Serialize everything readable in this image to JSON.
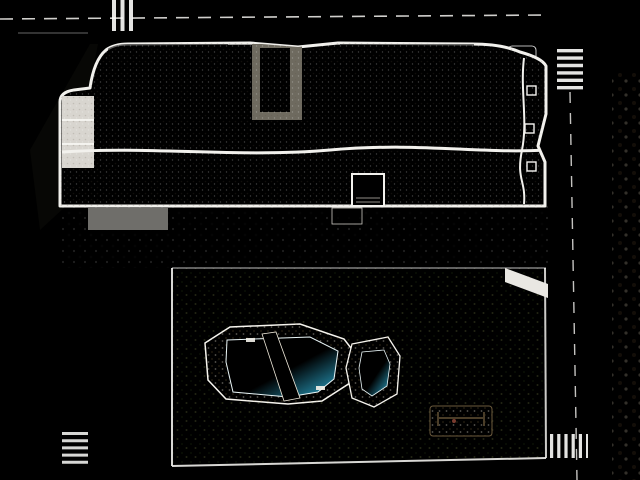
{
  "scene_description": "Aerial 3D architectural render of a white apartment complex with gravel roof terraces and parasols, a landscaped garden with a freeform swimming pool and kids pool, parking strip, surrounding streets and a sandy vacant lot",
  "colors": {
    "road": "#c0beba",
    "road_dark": "#b3b1ad",
    "sidewalk_top": "#d6c5b1",
    "sidewalk_left": "#dcc6b4",
    "sidewalk_pink": "#cf9a89",
    "dirt": "#c2a17c",
    "dirt_dark": "#9b8160",
    "grass": "#6f7d3f",
    "grass_dark": "#5b6a34",
    "terrace_grass": "#576139",
    "concrete": "#b7b5af",
    "parking": "#a9a7a1",
    "deck_stone": "#c9b38a",
    "planter_sand": "#c3a268",
    "pool_water": "#41bddd",
    "pool_water_light": "#90ddef",
    "roof_gravel": "#c6baa6",
    "roof_gravel_light": "#d3c8b3",
    "roof_dark": "#8d8779",
    "roof_black": "#32312d",
    "parapet_white": "#f2f1ed",
    "parasol_white": "#f7f6f2",
    "tree_light": "#b6ba6e",
    "tree_mid": "#7d8c4a",
    "tree_dark": "#46582c",
    "palm_dark": "#3f5a2c",
    "hedge": "#3d5429",
    "car_dark": "#3a3d40",
    "car_white": "#ebeae6",
    "car_silver": "#b9bdbf",
    "car_blue": "#5c6e80",
    "shadow": "#23251c"
  },
  "scene": {
    "parasols": [
      {
        "x": 102,
        "y": 54,
        "s": 24,
        "r": 15
      },
      {
        "x": 88,
        "y": 118,
        "s": 28,
        "r": -12
      },
      {
        "x": 228,
        "y": 118,
        "s": 28,
        "r": 10
      },
      {
        "x": 262,
        "y": 66,
        "s": 24,
        "r": -8
      },
      {
        "x": 330,
        "y": 64,
        "s": 26,
        "r": 12
      },
      {
        "x": 280,
        "y": 124,
        "s": 24,
        "r": 42
      },
      {
        "x": 316,
        "y": 124,
        "s": 24,
        "r": -18
      },
      {
        "x": 448,
        "y": 60,
        "s": 24,
        "r": -10
      },
      {
        "x": 476,
        "y": 60,
        "s": 26,
        "r": 14
      },
      {
        "x": 346,
        "y": 128,
        "s": 20,
        "r": -28
      },
      {
        "x": 496,
        "y": 130,
        "s": 24,
        "r": 18
      },
      {
        "x": 398,
        "y": 50,
        "s": 22,
        "r": 8
      }
    ],
    "roof_acs": [
      {
        "x": 168,
        "y": 118
      },
      {
        "x": 190,
        "y": 62
      },
      {
        "x": 208,
        "y": 94
      },
      {
        "x": 214,
        "y": 128
      },
      {
        "x": 238,
        "y": 86
      },
      {
        "x": 312,
        "y": 66
      },
      {
        "x": 318,
        "y": 126
      },
      {
        "x": 342,
        "y": 126
      },
      {
        "x": 366,
        "y": 98
      },
      {
        "x": 402,
        "y": 126
      },
      {
        "x": 412,
        "y": 64
      },
      {
        "x": 434,
        "y": 90
      },
      {
        "x": 448,
        "y": 128
      },
      {
        "x": 470,
        "y": 62
      },
      {
        "x": 492,
        "y": 126
      },
      {
        "x": 508,
        "y": 90
      },
      {
        "x": 524,
        "y": 62
      },
      {
        "x": 530,
        "y": 120
      }
    ],
    "roof_hatches": [
      {
        "x": 160,
        "y": 56
      },
      {
        "x": 254,
        "y": 124
      },
      {
        "x": 302,
        "y": 56
      },
      {
        "x": 354,
        "y": 126
      },
      {
        "x": 420,
        "y": 56
      },
      {
        "x": 500,
        "y": 56
      },
      {
        "x": 286,
        "y": 92
      },
      {
        "x": 452,
        "y": 92
      }
    ],
    "roof_loungers": [
      {
        "x": 296,
        "y": 108,
        "n": 2
      },
      {
        "x": 330,
        "y": 114,
        "n": 3
      },
      {
        "x": 408,
        "y": 116,
        "n": 2
      },
      {
        "x": 462,
        "y": 100,
        "n": 2
      }
    ],
    "terrace_boxes": [
      {
        "x": 64,
        "w": 46
      },
      {
        "x": 112,
        "w": 46
      },
      {
        "x": 160,
        "w": 46
      },
      {
        "x": 208,
        "w": 46
      },
      {
        "x": 256,
        "w": 46
      },
      {
        "x": 304,
        "w": 46
      },
      {
        "x": 384,
        "w": 46
      },
      {
        "x": 432,
        "w": 46
      },
      {
        "x": 480,
        "w": 40
      },
      {
        "x": 522,
        "w": 21
      }
    ],
    "planters": [
      {
        "x": 128,
        "y": 238,
        "w": 62,
        "h": 24
      },
      {
        "x": 243,
        "y": 236,
        "w": 66,
        "h": 24
      },
      {
        "x": 406,
        "y": 236,
        "w": 66,
        "h": 22
      }
    ],
    "benches": [
      {
        "x": 74,
        "y": 246,
        "w": 20,
        "h": 5
      },
      {
        "x": 200,
        "y": 230,
        "w": 16,
        "h": 4
      },
      {
        "x": 322,
        "y": 230,
        "w": 16,
        "h": 4
      },
      {
        "x": 488,
        "y": 230,
        "w": 14,
        "h": 4
      }
    ],
    "slat_groups": [
      {
        "x": 352,
        "y": 268,
        "n": 7,
        "w": 26,
        "h": 4,
        "gap": 2.5,
        "r": -2,
        "c": "#c49f63"
      },
      {
        "x": 468,
        "y": 348,
        "n": 6,
        "w": 26,
        "h": 5,
        "gap": 2.5,
        "r": 0,
        "c": "#cbb184"
      }
    ],
    "trees": [
      {
        "x": 196,
        "y": 288,
        "r": 22,
        "t": "light"
      },
      {
        "x": 238,
        "y": 296,
        "r": 16,
        "t": "mid"
      },
      {
        "x": 262,
        "y": 300,
        "r": 12,
        "t": "dark"
      },
      {
        "x": 300,
        "y": 288,
        "r": 14,
        "t": "dark"
      },
      {
        "x": 336,
        "y": 292,
        "r": 12,
        "t": "mid"
      },
      {
        "x": 428,
        "y": 292,
        "r": 12,
        "t": "dark"
      },
      {
        "x": 452,
        "y": 288,
        "r": 10,
        "t": "mid"
      },
      {
        "x": 516,
        "y": 296,
        "r": 20,
        "t": "light"
      },
      {
        "x": 542,
        "y": 306,
        "r": 14,
        "t": "mid"
      },
      {
        "x": 178,
        "y": 322,
        "r": 12,
        "t": "mid"
      },
      {
        "x": 186,
        "y": 452,
        "r": 16,
        "t": "light"
      },
      {
        "x": 214,
        "y": 466,
        "r": 12,
        "t": "mid"
      },
      {
        "x": 540,
        "y": 336,
        "r": 16,
        "t": "light"
      },
      {
        "x": 534,
        "y": 390,
        "r": 14,
        "t": "mid"
      },
      {
        "x": 544,
        "y": 448,
        "r": 18,
        "t": "light"
      },
      {
        "x": 306,
        "y": 428,
        "r": 14,
        "t": "mid"
      },
      {
        "x": 330,
        "y": 458,
        "r": 16,
        "t": "light"
      },
      {
        "x": 444,
        "y": 462,
        "r": 14,
        "t": "mid"
      },
      {
        "x": 252,
        "y": 470,
        "r": 12,
        "t": "mid"
      },
      {
        "x": 386,
        "y": 470,
        "r": 10,
        "t": "dark"
      },
      {
        "x": 206,
        "y": 330,
        "r": 8,
        "t": "dark"
      },
      {
        "x": 560,
        "y": 468,
        "r": 12,
        "t": "mid"
      }
    ],
    "palms": [
      {
        "x": 304,
        "y": 37,
        "r": 9
      },
      {
        "x": 430,
        "y": 36,
        "r": 9
      },
      {
        "x": 547,
        "y": 37,
        "r": 8
      },
      {
        "x": 614,
        "y": 24,
        "r": 10
      },
      {
        "x": 633,
        "y": 42,
        "r": 7
      }
    ],
    "bushes_left": [
      {
        "x": 10,
        "y": 150,
        "r": 6
      },
      {
        "x": 4,
        "y": 212,
        "r": 5
      },
      {
        "x": 16,
        "y": 300,
        "r": 7
      },
      {
        "x": 8,
        "y": 372,
        "r": 6
      },
      {
        "x": 20,
        "y": 442,
        "r": 7
      },
      {
        "x": 34,
        "y": 466,
        "r": 6
      }
    ],
    "bushes_dirt": [
      {
        "x": 600,
        "y": 160,
        "r": 4
      },
      {
        "x": 606,
        "y": 215,
        "r": 5
      },
      {
        "x": 598,
        "y": 262,
        "r": 4
      },
      {
        "x": 604,
        "y": 334,
        "r": 5
      },
      {
        "x": 600,
        "y": 392,
        "r": 4
      },
      {
        "x": 606,
        "y": 452,
        "r": 5
      }
    ],
    "dirt_patches": [
      {
        "x": 620,
        "y": 150,
        "rx": 18,
        "ry": 10
      },
      {
        "x": 616,
        "y": 240,
        "rx": 22,
        "ry": 12
      },
      {
        "x": 624,
        "y": 320,
        "rx": 20,
        "ry": 10
      },
      {
        "x": 618,
        "y": 400,
        "rx": 22,
        "ry": 12
      },
      {
        "x": 628,
        "y": 460,
        "rx": 16,
        "ry": 8
      }
    ],
    "dirt_shadows": [
      {
        "x": 596,
        "y": 185,
        "rx": 32,
        "ry": 9,
        "r": -32
      },
      {
        "x": 600,
        "y": 292,
        "rx": 36,
        "ry": 10,
        "r": -32
      },
      {
        "x": 602,
        "y": 408,
        "rx": 30,
        "ry": 8,
        "r": -32
      },
      {
        "x": 612,
        "y": 118,
        "rx": 20,
        "ry": 6,
        "r": -32
      }
    ],
    "road_shadows": [
      {
        "x": 566,
        "y": 150,
        "rx": 30,
        "ry": 8,
        "r": -18
      },
      {
        "x": 562,
        "y": 248,
        "rx": 34,
        "ry": 9,
        "r": -18
      },
      {
        "x": 566,
        "y": 352,
        "rx": 30,
        "ry": 8,
        "r": -18
      },
      {
        "x": 560,
        "y": 432,
        "rx": 26,
        "ry": 7,
        "r": -18
      },
      {
        "x": 60,
        "y": 300,
        "rx": 26,
        "ry": 8,
        "r": -25
      },
      {
        "x": 56,
        "y": 390,
        "rx": 24,
        "ry": 8,
        "r": -25
      }
    ],
    "cars": [
      {
        "x": 384,
        "y": 2,
        "w": 52,
        "h": 10,
        "c": "#dcdad6",
        "r": 1
      },
      {
        "x": 436,
        "y": 1,
        "w": 16,
        "h": 11,
        "c": "#f2f1ee",
        "r": 1
      },
      {
        "x": 492,
        "y": 0,
        "w": 26,
        "h": 10,
        "c": "#ebeae6",
        "r": 2
      },
      {
        "x": 482,
        "y": 30,
        "w": 21,
        "h": 9,
        "c": "#3a3d40",
        "r": 0
      },
      {
        "x": 505,
        "y": 18,
        "w": 15,
        "h": 9,
        "c": "#55585c",
        "r": 8
      },
      {
        "x": 112,
        "y": 330,
        "w": 30,
        "h": 13,
        "c": "#e9e8e4",
        "r": -8
      },
      {
        "x": 114,
        "y": 372,
        "w": 30,
        "h": 12,
        "c": "#b9bdbf",
        "r": -8
      },
      {
        "x": 112,
        "y": 410,
        "w": 30,
        "h": 12,
        "c": "#3c4043",
        "r": -8
      },
      {
        "x": 512,
        "y": 238,
        "w": 15,
        "h": 30,
        "c": "#eceae8",
        "r": 2
      },
      {
        "x": 8,
        "y": 474,
        "w": 18,
        "h": 6,
        "c": "#44474a",
        "r": 3
      },
      {
        "x": 108,
        "y": 472,
        "w": 26,
        "h": 8,
        "c": "#5c6e80",
        "r": 2
      },
      {
        "x": 178,
        "y": 474,
        "w": 18,
        "h": 6,
        "c": "#3c3f42",
        "r": 0
      },
      {
        "x": 320,
        "y": 470,
        "w": 22,
        "h": 9,
        "c": "#3a3d40",
        "r": 0
      },
      {
        "x": 452,
        "y": 468,
        "w": 38,
        "h": 12,
        "c": "#46494c",
        "r": 1
      },
      {
        "x": 560,
        "y": 472,
        "w": 22,
        "h": 8,
        "c": "#a8abad",
        "r": 0
      },
      {
        "x": 604,
        "y": 474,
        "w": 20,
        "h": 6,
        "c": "#35383b",
        "r": 0
      }
    ],
    "small_vehicles": [
      {
        "x": 572,
        "y": 152
      },
      {
        "x": 568,
        "y": 336
      },
      {
        "x": 574,
        "y": 430
      },
      {
        "x": 540,
        "y": 55
      }
    ],
    "lamps": [
      {
        "x": 600,
        "y": 128
      },
      {
        "x": 600,
        "y": 222
      },
      {
        "x": 600,
        "y": 318
      },
      {
        "x": 602,
        "y": 412
      },
      {
        "x": 556,
        "y": 36
      },
      {
        "x": 214,
        "y": 8
      }
    ],
    "parking_lines": {
      "x1": 90,
      "x2": 168,
      "ys": [
        252,
        290,
        328,
        366,
        404,
        442
      ]
    },
    "divider_lines": [
      [
        134,
        46,
        150
      ],
      [
        182,
        52,
        172
      ],
      [
        230,
        44,
        172
      ],
      [
        252,
        44,
        120
      ],
      [
        300,
        44,
        120
      ],
      [
        326,
        46,
        172
      ],
      [
        352,
        56,
        172
      ],
      [
        398,
        56,
        172
      ],
      [
        422,
        46,
        150
      ],
      [
        446,
        46,
        172
      ],
      [
        470,
        46,
        150
      ],
      [
        494,
        46,
        172
      ],
      [
        518,
        46,
        172
      ]
    ],
    "pergola": {
      "x1": 70,
      "x2": 536,
      "step": 24,
      "y1": 153,
      "y2": 171
    },
    "promenade_shadows": [
      150,
      196,
      242,
      288,
      334,
      430,
      476
    ],
    "pole_shadows": [
      [
        50,
        6,
        120,
        14
      ],
      [
        196,
        2,
        258,
        16
      ],
      [
        536,
        2,
        598,
        18
      ],
      [
        560,
        6,
        610,
        2
      ]
    ],
    "pool_loungers": [
      {
        "x": 252,
        "y": 330,
        "r": -5,
        "c": "#f4f3ef"
      },
      {
        "x": 272,
        "y": 329,
        "r": -5,
        "c": "#f4f3ef"
      },
      {
        "x": 292,
        "y": 331,
        "r": -5,
        "c": "#f4f3ef"
      },
      {
        "x": 288,
        "y": 393,
        "r": 10,
        "c": "#f4f3ef"
      },
      {
        "x": 306,
        "y": 390,
        "r": 10,
        "c": "#f4f3ef"
      },
      {
        "x": 208,
        "y": 358,
        "r": 80,
        "c": "#f4f3ef"
      },
      {
        "x": 334,
        "y": 368,
        "r": 20,
        "c": "#c9a06b"
      },
      {
        "x": 336,
        "y": 378,
        "r": 20,
        "c": "#c9a06b"
      }
    ],
    "pool_parasols": [
      {
        "x": 276,
        "y": 327,
        "s": 18,
        "r": 20
      },
      {
        "x": 262,
        "y": 396,
        "s": 18,
        "r": -15
      },
      {
        "x": 330,
        "y": 402,
        "s": 15,
        "r": 12
      }
    ],
    "wing_loungers": [
      {
        "x": 70,
        "y": 104
      },
      {
        "x": 70,
        "y": 128
      },
      {
        "x": 70,
        "y": 152
      }
    ]
  }
}
